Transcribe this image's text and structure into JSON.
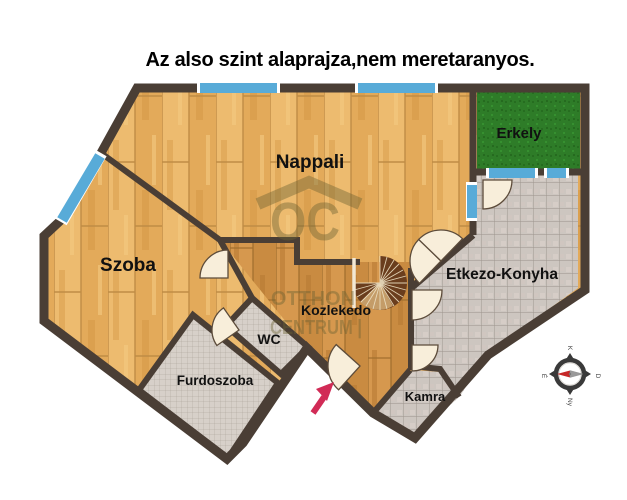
{
  "title": "Az also szint alaprajza,nem meretaranyos.",
  "rooms": {
    "nappali": {
      "label": "Nappali"
    },
    "szoba": {
      "label": "Szoba"
    },
    "erkely": {
      "label": "Erkely"
    },
    "etkezo_konyha": {
      "label": "Etkezo-Konyha"
    },
    "kozlekedo": {
      "label": "Kozlekedo"
    },
    "wc": {
      "label": "WC"
    },
    "furdoszoba": {
      "label": "Furdoszoba"
    },
    "kamra": {
      "label": "Kamra"
    }
  },
  "watermark": {
    "logo": "OC",
    "line1": "OTTHON",
    "line2": "CENTRUM |"
  },
  "compass": {
    "north": "É",
    "east": "K",
    "south": "D",
    "west": "Ny"
  },
  "colors": {
    "wall": "#4a3e35",
    "wood_light": "#e9b264",
    "wood_hall": "#d2914a",
    "tile_kitchen": "#cdc6c0",
    "tile_bath": "#d7d0c9",
    "balcony_green": "#2e7c28",
    "window_blue": "#58abd8",
    "door_cream": "#f8eeda",
    "entry_arrow": "#d12b56",
    "watermark": "#6b6233"
  }
}
